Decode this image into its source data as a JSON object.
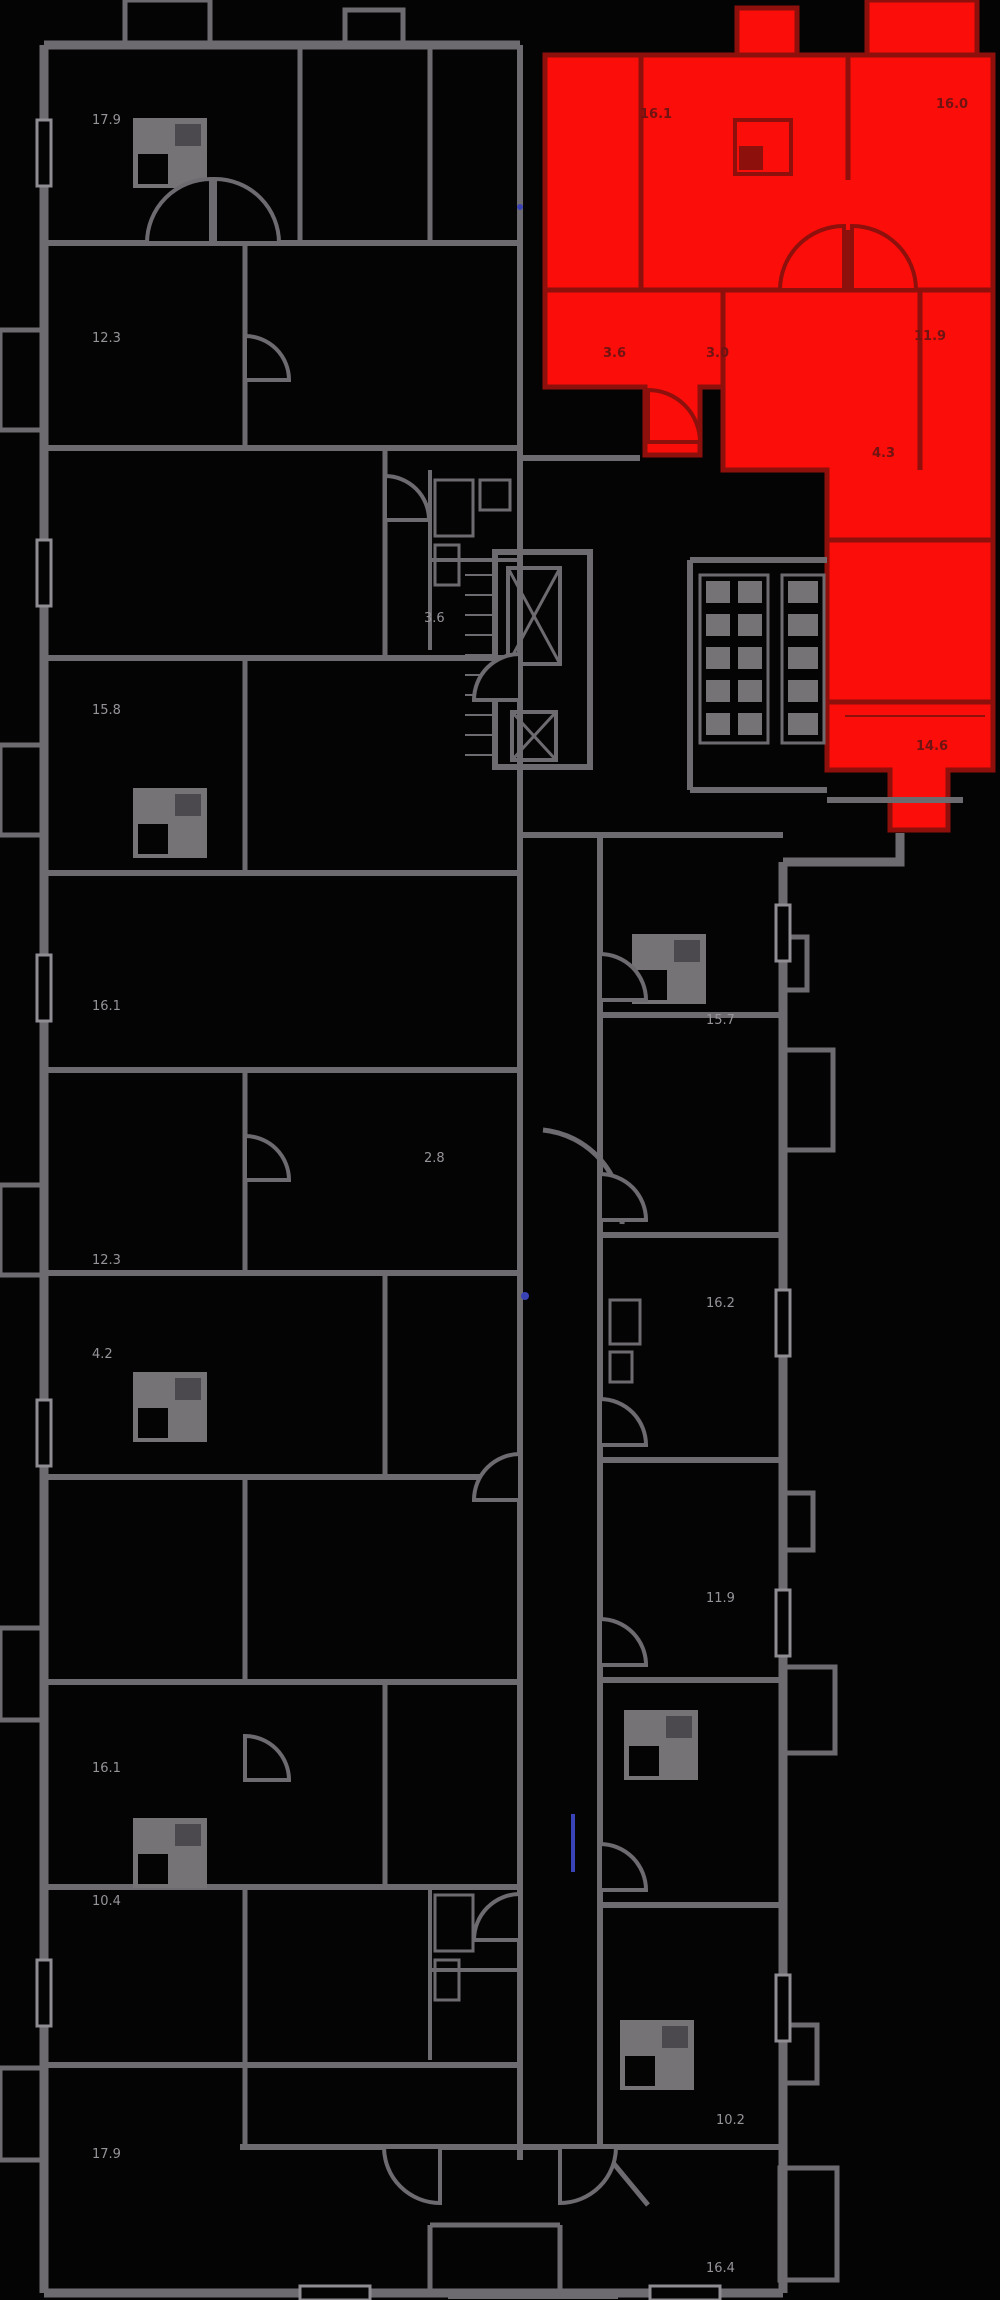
{
  "document": {
    "kind": "residential-floorplan",
    "highlighted_units": 1
  },
  "colors": {
    "bg": "#050405",
    "wall": "#6e6b70",
    "wall-light": "#8f8c92",
    "fix": "#767376",
    "red": "#fb0d09",
    "red-wall": "#8e100c",
    "red-label": "#6f1412",
    "label": "#969399",
    "blue": "#3a43b5"
  },
  "icons": {
    "elevator": "x-braced-shaft",
    "stairs": "ladder-rungs",
    "kitchen": "stove-square",
    "door": "quarter-arc-leaf",
    "vent": "small-square-grid"
  },
  "selected_unit": {
    "state": "selected",
    "labels": [
      {
        "t": "16.1",
        "x": 640,
        "y": 118
      },
      {
        "t": "16.0",
        "x": 936,
        "y": 108
      },
      {
        "t": "3.6",
        "x": 603,
        "y": 357
      },
      {
        "t": "3.0",
        "x": 706,
        "y": 357
      },
      {
        "t": "11.9",
        "x": 914,
        "y": 340
      },
      {
        "t": "4.3",
        "x": 872,
        "y": 457
      },
      {
        "t": "14.6",
        "x": 916,
        "y": 750
      }
    ]
  },
  "area_labels": [
    {
      "t": "17.9",
      "x": 92,
      "y": 124
    },
    {
      "t": "12.3",
      "x": 92,
      "y": 342
    },
    {
      "t": "15.8",
      "x": 92,
      "y": 714
    },
    {
      "t": "16.1",
      "x": 92,
      "y": 1010
    },
    {
      "t": "12.3",
      "x": 92,
      "y": 1264
    },
    {
      "t": "4.2",
      "x": 92,
      "y": 1358
    },
    {
      "t": "16.1",
      "x": 92,
      "y": 1772
    },
    {
      "t": "10.4",
      "x": 92,
      "y": 1905
    },
    {
      "t": "17.9",
      "x": 92,
      "y": 2158
    },
    {
      "t": "3.6",
      "x": 424,
      "y": 622
    },
    {
      "t": "2.8",
      "x": 424,
      "y": 1162
    },
    {
      "t": "15.7",
      "x": 706,
      "y": 1024
    },
    {
      "t": "16.2",
      "x": 706,
      "y": 1307
    },
    {
      "t": "11.9",
      "x": 706,
      "y": 1602
    },
    {
      "t": "10.2",
      "x": 716,
      "y": 2124
    },
    {
      "t": "16.4",
      "x": 706,
      "y": 2272
    }
  ]
}
